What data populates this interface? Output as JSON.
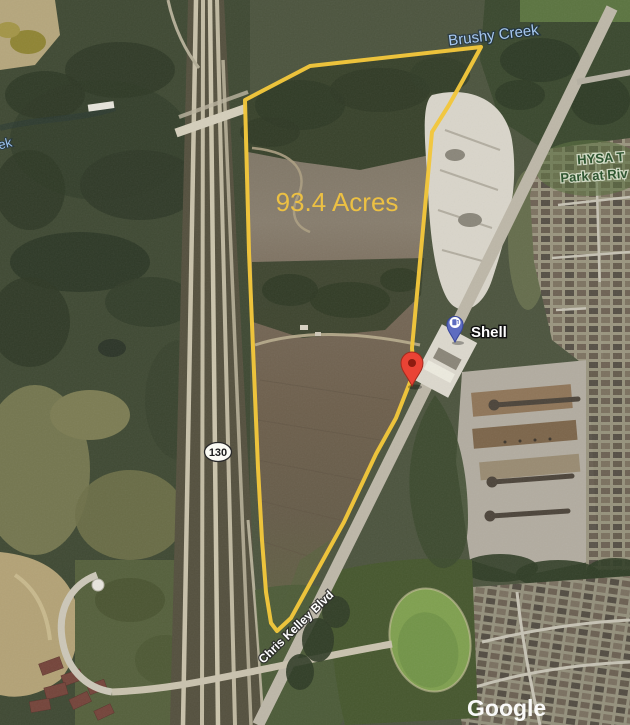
{
  "map": {
    "watermark": "Google",
    "parcel": {
      "acreage_label": "93.4 Acres",
      "outline_color": "#F2C63C",
      "acreage_text_color": "#ECC043"
    },
    "labels": {
      "creek": "Brushy Creek",
      "creek_fragment": "ek",
      "park_line1": "HYSA T",
      "park_line2": "Park at Riv",
      "road": "Chris Kelley Blvd",
      "highway_shield": "130"
    },
    "markers": {
      "gas_station": {
        "label": "Shell",
        "pin_color": "#5D6CC0",
        "type": "gas-station"
      },
      "dropped_pin": {
        "pin_color": "#EA4335",
        "type": "location"
      }
    },
    "colors": {
      "water_label": "#A6C8F0",
      "park_label": "#2E5530"
    }
  }
}
